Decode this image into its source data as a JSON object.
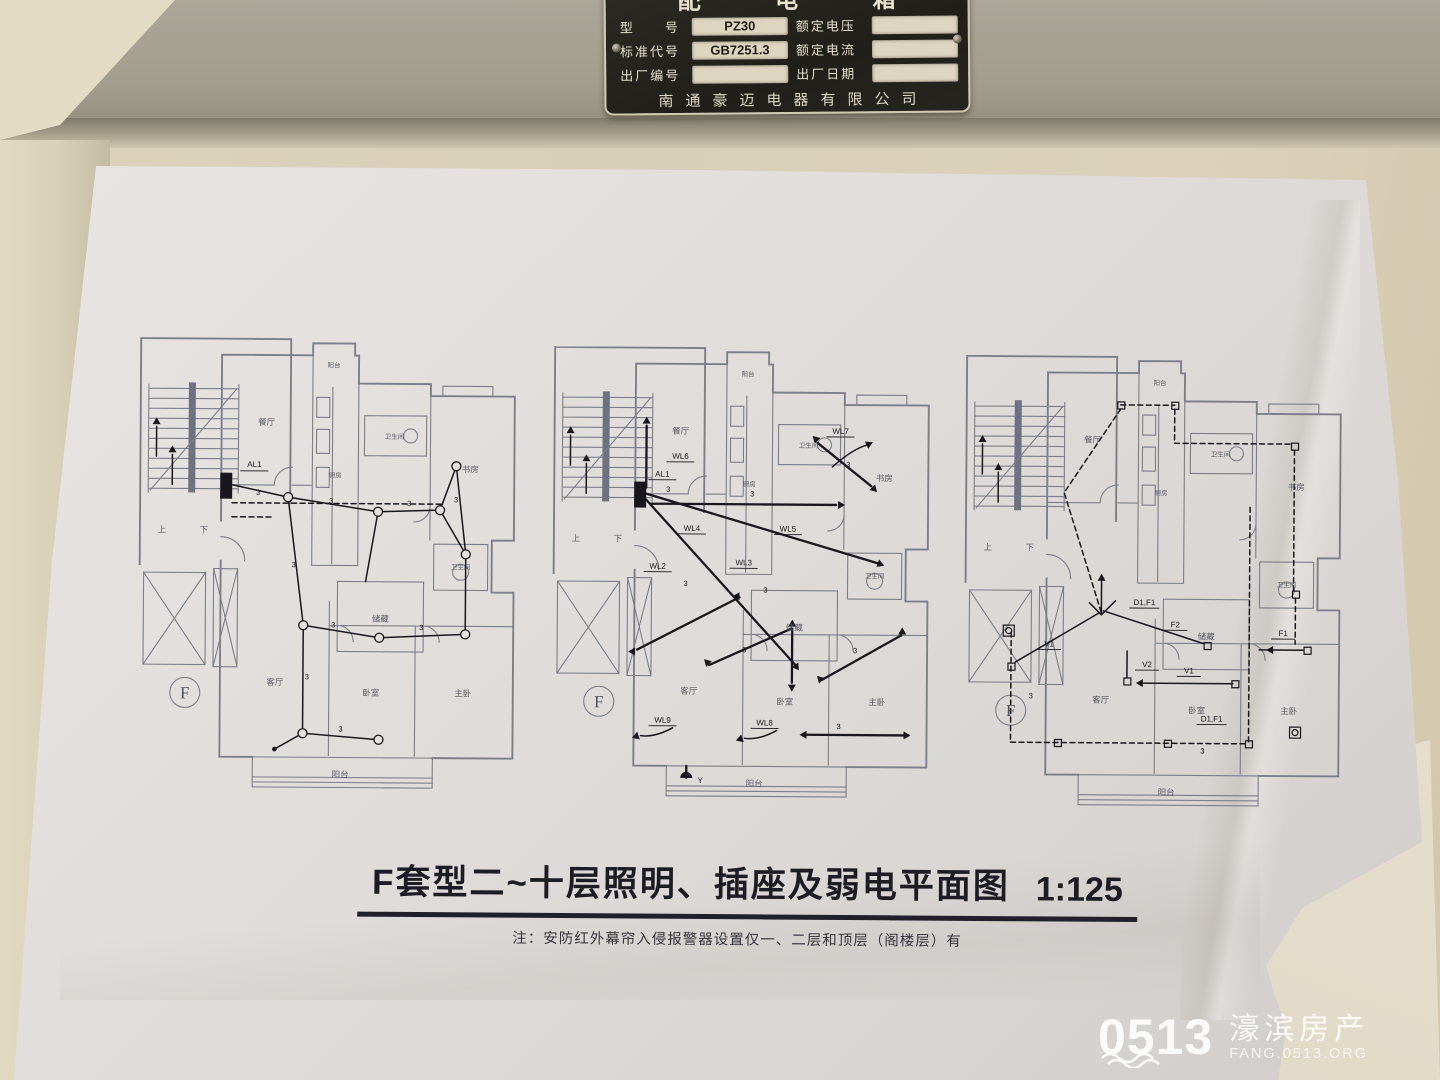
{
  "nameplate": {
    "title": "配 电 箱",
    "company": "南通豪迈电器有限公司",
    "fields": {
      "model_label": "型　　号",
      "model_value": "PZ30",
      "voltage_label": "额定电压",
      "voltage_value": "",
      "standard_label": "标准代号",
      "standard_value": "GB7251.3",
      "current_label": "额定电流",
      "current_value": "",
      "serial_label": "出厂编号",
      "serial_value": "",
      "date_label": "出厂日期",
      "date_value": ""
    }
  },
  "drawing": {
    "title": "F套型二~十层照明、插座及弱电平面图",
    "scale": "1:125",
    "note": "注：安防红外幕帘入侵报警器设置仅一、二层和顶层（阁楼层）有",
    "unit_label": "F",
    "wire_size": "3",
    "stairs_up": "上",
    "stairs_down": "下",
    "panel_label": "AL1",
    "pendant_label": "Y",
    "rooms": {
      "dining": "餐厅",
      "balcony_top": "阳台",
      "kitchen": "厨房",
      "bath": "卫生间",
      "study": "书房",
      "storage": "储藏",
      "bath2": "卫生间",
      "living": "客厅",
      "bedroom": "卧室",
      "master": "主卧",
      "balcony": "阳台"
    },
    "circuits": {
      "wl2": "WL2",
      "wl3": "WL3",
      "wl4": "WL4",
      "wl5": "WL5",
      "wl6": "WL6",
      "wl7": "WL7",
      "wl8": "WL8",
      "wl9": "WL9"
    },
    "weak": {
      "v1": "V1",
      "v2": "V2",
      "f1": "F1",
      "f2": "F2",
      "d1f1": "D1,F1"
    }
  },
  "watermark": {
    "logo": "0513",
    "name": "濠滨房产",
    "url": "FANG.0513.ORG"
  }
}
